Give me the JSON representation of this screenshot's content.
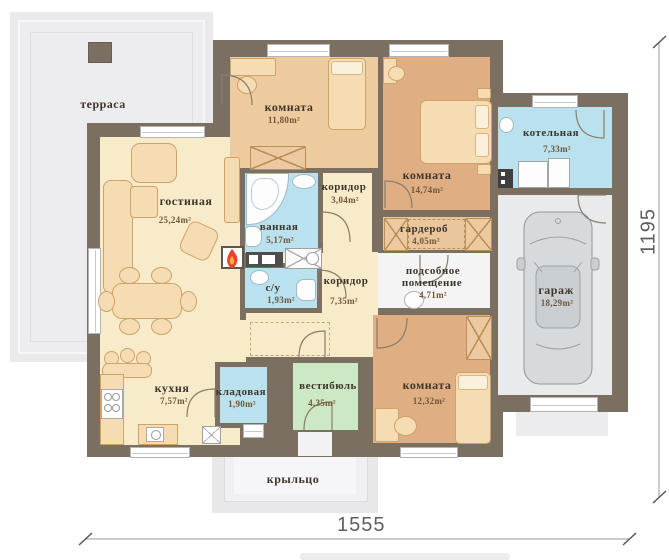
{
  "plan_title": "floor-plan",
  "dimensions": {
    "width_label": "1555",
    "height_label": "1195"
  },
  "rooms": {
    "terrace": {
      "label": "терраса"
    },
    "living": {
      "label": "гостиная",
      "area": "25,24m²"
    },
    "bedroom1": {
      "label": "комната",
      "area": "11,80m²"
    },
    "bedroom2": {
      "label": "комната",
      "area": "14,74m²"
    },
    "boiler": {
      "label": "котельная",
      "area": "7,33m²"
    },
    "bathroom": {
      "label": "ванная",
      "area": "5,17m²"
    },
    "corridor1": {
      "label": "коридор",
      "area": "3,04m²"
    },
    "wardrobe": {
      "label": "гардероб",
      "area": "4,05m²"
    },
    "wc": {
      "label": "с/у",
      "area": "1,93m²"
    },
    "corridor2": {
      "label": "коридор",
      "area": "7,35m²"
    },
    "utility": {
      "label_line1": "подсобное",
      "label_line2": "помещение",
      "area": "4,71m²"
    },
    "garage": {
      "label": "гараж",
      "area": "18,29m²"
    },
    "kitchen": {
      "label": "кухня",
      "area": "7,57m²"
    },
    "pantry": {
      "label": "кладовая",
      "area": "1,90m²"
    },
    "vestibule": {
      "label": "вестибюль",
      "area": "4,35m²"
    },
    "bedroom3": {
      "label": "комната",
      "area": "12,32m²"
    },
    "porch": {
      "label": "крыльцо"
    }
  },
  "colors": {
    "wall": "#7b6f62",
    "warm_floor": "#f8ebc9",
    "bedroom_light": "#eecb9e",
    "bedroom_dark": "#dfae82",
    "wet_room": "#b9e1ee",
    "vestibule_green": "#cde9c3",
    "garage_floor": "#e9eaec",
    "utility_floor": "#f4f4f5",
    "terrace_gray": "#ececee",
    "furniture": "#f6dcb2",
    "flame_outer": "#e8432b",
    "flame_inner": "#ffb13d"
  }
}
